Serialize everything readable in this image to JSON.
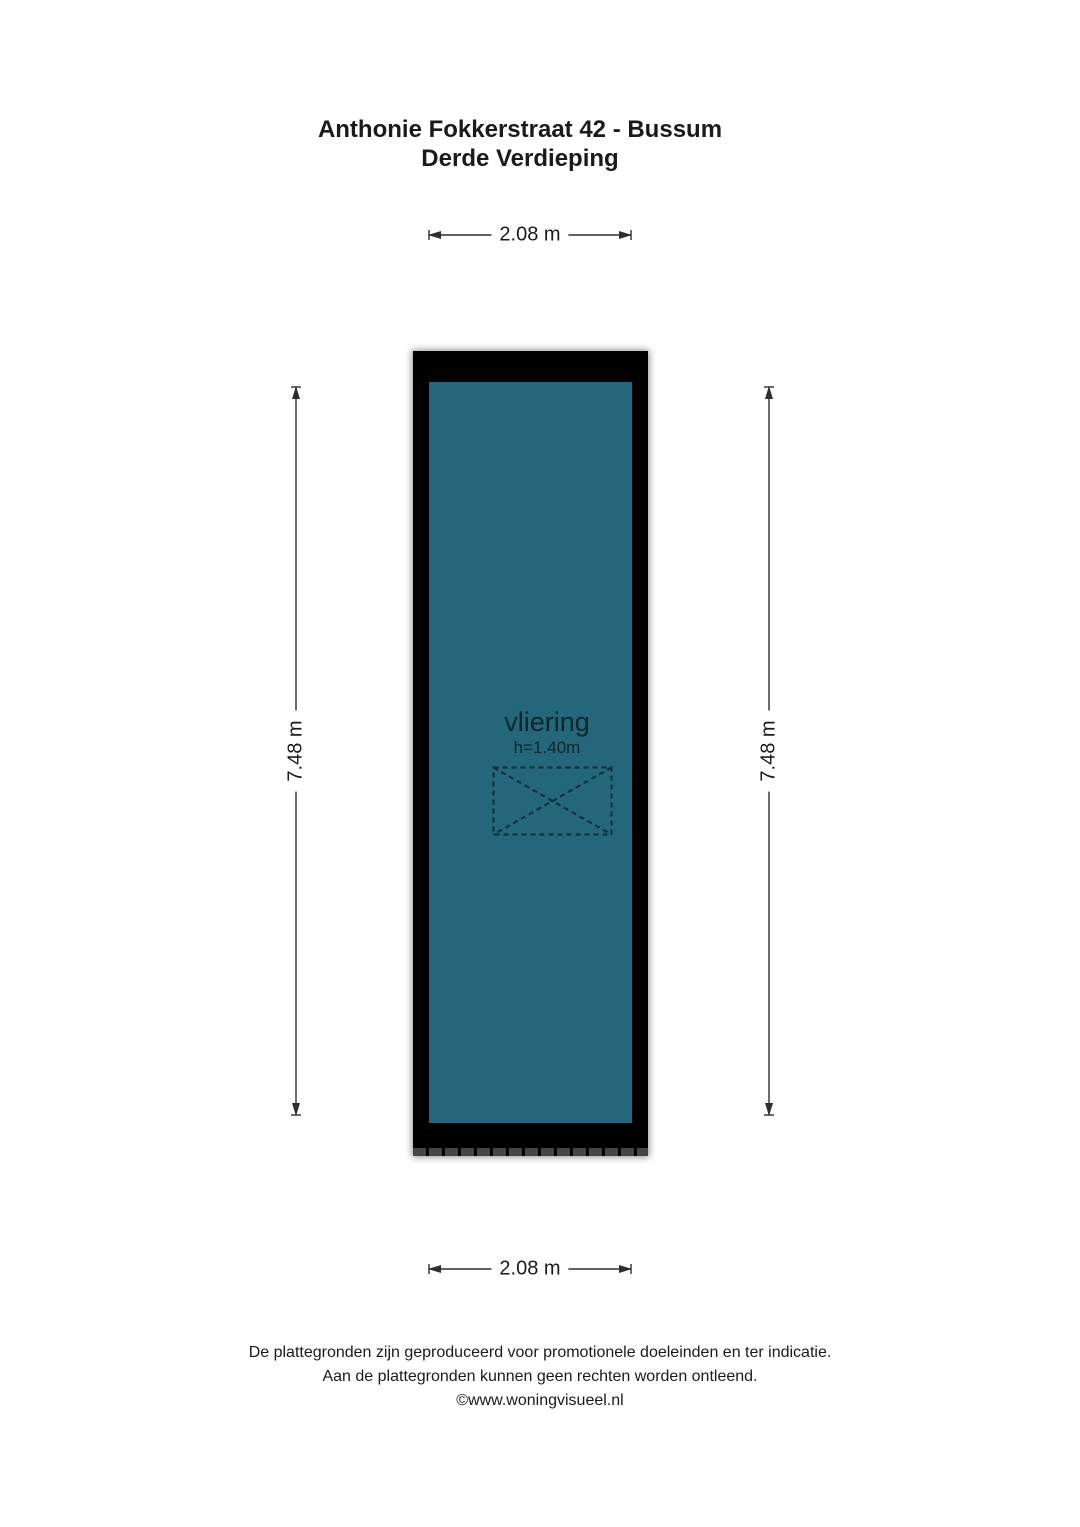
{
  "title": {
    "line1": "Anthonie Fokkerstraat 42 - Bussum",
    "line2": "Derde Verdieping"
  },
  "dimensions": {
    "top_width": "2.08 m",
    "bottom_width": "2.08 m",
    "left_height": "7.48 m",
    "right_height": "7.48 m"
  },
  "room": {
    "name": "vliering",
    "height_note": "h=1.40m"
  },
  "footer": {
    "line1": "De plattegronden zijn geproduceerd voor promotionele doeleinden en ter indicatie.",
    "line2": "Aan de plattegronden kunnen geen rechten worden ontleend.",
    "line3": "©www.woningvisueel.nl"
  },
  "colors": {
    "floor": "#24667a",
    "wall": "#000000",
    "hatch": "#454545",
    "line": "#2e2e2e",
    "open": "#0c2e39",
    "text": "#1a1a1a"
  }
}
